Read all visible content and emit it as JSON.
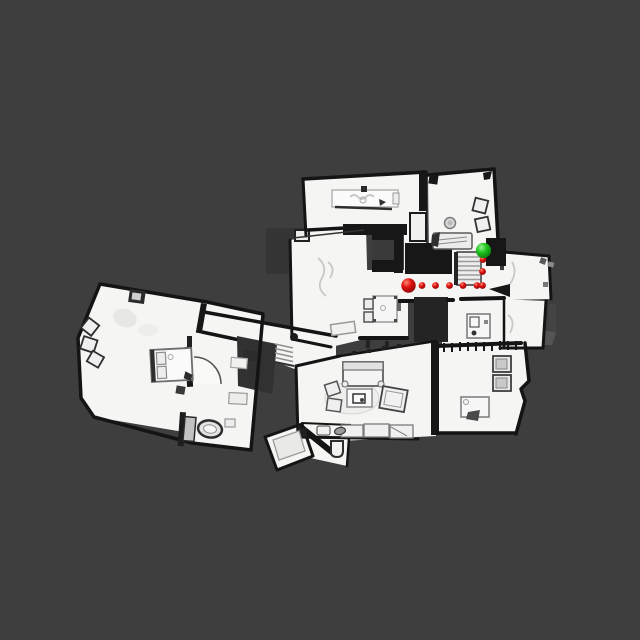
{
  "scene": {
    "description": "top-down 3D house scan floor plan with navigation path markers",
    "background_color": "#3e3e3e",
    "floor_color": "#f5f5f3",
    "wall_color": "#141414"
  },
  "markers": {
    "start": {
      "name": "start-marker",
      "x": 408.5,
      "y": 285.5,
      "r": 7.2,
      "color": "#d41010"
    },
    "goal": {
      "name": "goal-marker",
      "x": 483.5,
      "y": 250.5,
      "r": 7.6,
      "color": "#1fc41f"
    },
    "path_dots": {
      "name": "path-dot",
      "color": "#d41010",
      "r": 3.4,
      "points": [
        [
          422.0,
          285.5
        ],
        [
          435.5,
          285.5
        ],
        [
          449.5,
          285.5
        ],
        [
          463.0,
          285.5
        ],
        [
          477.0,
          285.5
        ],
        [
          482.5,
          285.5
        ],
        [
          482.5,
          271.5
        ],
        [
          483.0,
          259.5
        ]
      ]
    }
  }
}
